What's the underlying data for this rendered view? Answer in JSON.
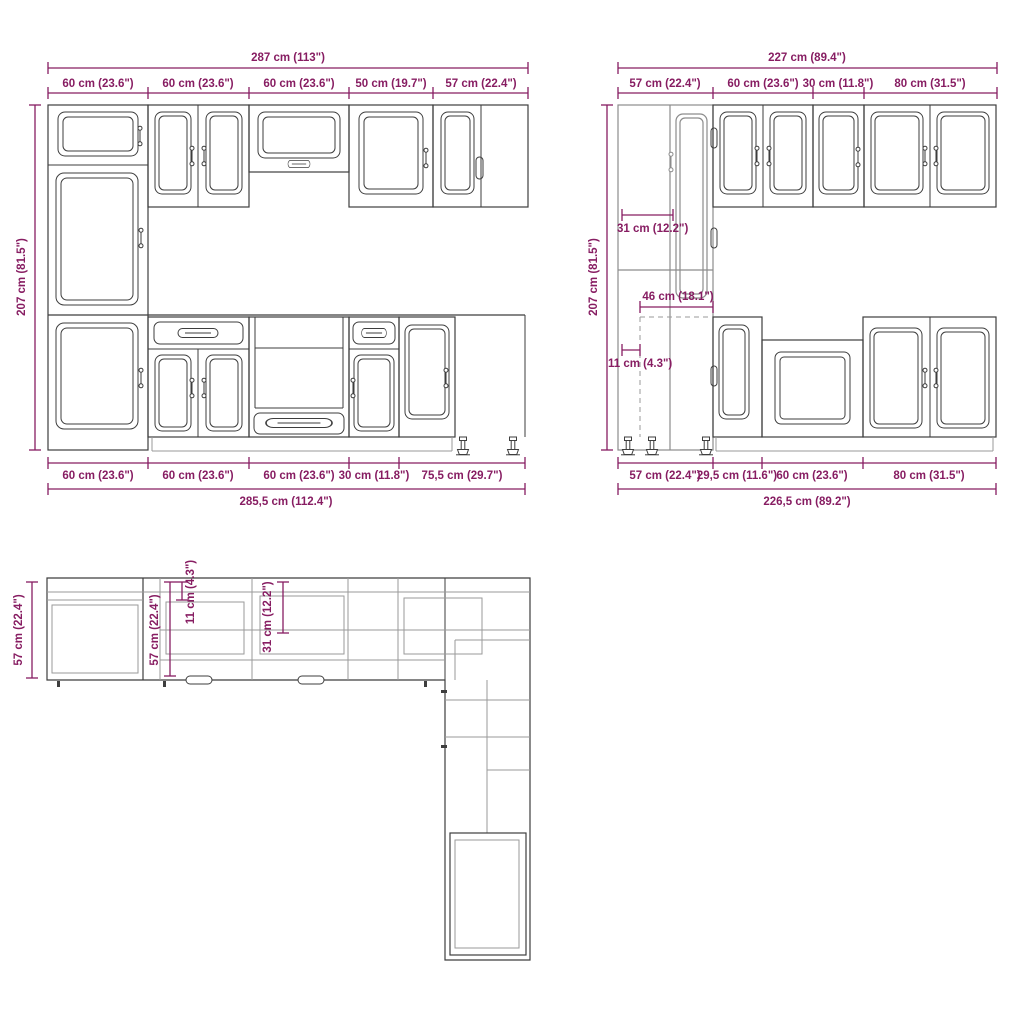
{
  "colors": {
    "dimension_accent": "#871d62",
    "drawing_line": "#3e3e3e",
    "drawing_line_light": "#9a9a9a"
  },
  "front_elevation": {
    "overall_width_top": "287 cm (113\")",
    "overall_height": "207 cm (81.5\")",
    "top_segments": [
      "60 cm (23.6\")",
      "60 cm (23.6\")",
      "60 cm (23.6\")",
      "50 cm (19.7\")",
      "57 cm (22.4\")"
    ],
    "bottom_segments": [
      "60 cm (23.6\")",
      "60 cm (23.6\")",
      "60 cm (23.6\")",
      "30 cm (11.8\")",
      "75,5 cm (29.7\")"
    ],
    "overall_width_bottom": "285,5 cm (112.4\")"
  },
  "side_elevation": {
    "overall_width_top": "227 cm (89.4\")",
    "overall_height": "207 cm (81.5\")",
    "top_segments": [
      "57 cm (22.4\")",
      "60 cm (23.6\")",
      "30 cm (11.8\")",
      "80 cm (31.5\")"
    ],
    "upper_cabinet_depth": "31 cm (12.2\")",
    "corner_clearance": "46 cm (18.1\")",
    "side_offset": "11 cm (4.3\")",
    "bottom_segments": [
      "57 cm (22.4\")",
      "29,5 cm (11.6\")",
      "60 cm (23.6\")",
      "80 cm (31.5\")"
    ],
    "overall_width_bottom": "226,5 cm (89.2\")"
  },
  "plan_view": {
    "left_run_depth": "57 cm (22.4\")",
    "counter_depth": "57 cm (22.4\")",
    "side_offset": "11 cm (4.3\")",
    "wall_cabinet_depth": "31 cm (12.2\")"
  }
}
